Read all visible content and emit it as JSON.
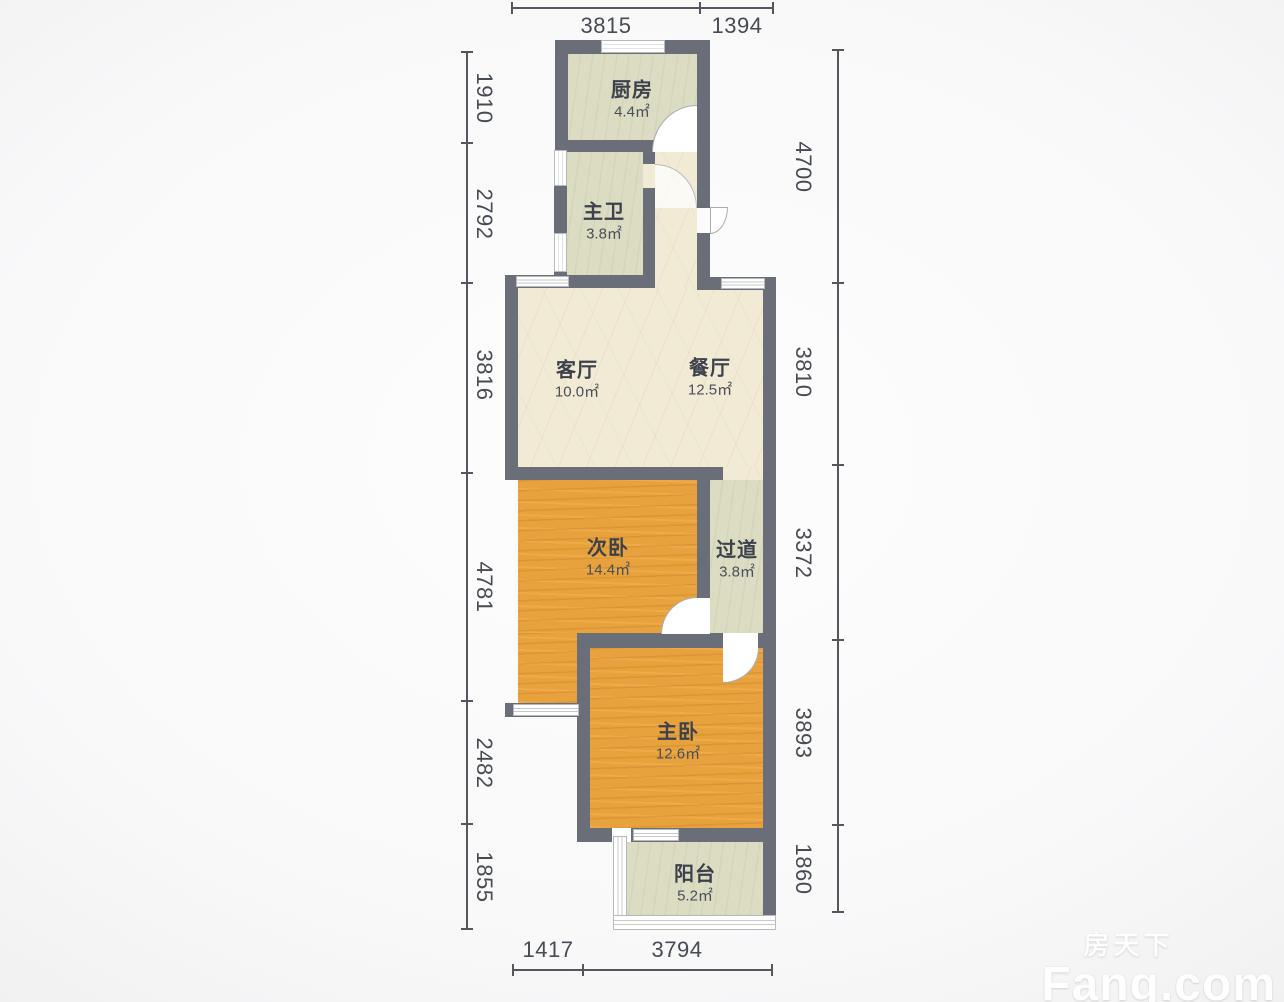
{
  "plan": {
    "rooms": [
      {
        "id": "kitchen",
        "name": "厨房",
        "area": "4.4㎡"
      },
      {
        "id": "master-bath",
        "name": "主卫",
        "area": "3.8㎡"
      },
      {
        "id": "living-room",
        "name": "客厅",
        "area": "10.0㎡"
      },
      {
        "id": "dining-room",
        "name": "餐厅",
        "area": "12.5㎡"
      },
      {
        "id": "second-bedroom",
        "name": "次卧",
        "area": "14.4㎡"
      },
      {
        "id": "hallway",
        "name": "过道",
        "area": "3.8㎡"
      },
      {
        "id": "master-bedroom",
        "name": "主卧",
        "area": "12.6㎡"
      },
      {
        "id": "balcony",
        "name": "阳台",
        "area": "5.2㎡"
      }
    ],
    "dimensions": {
      "top": [
        "3815",
        "1394"
      ],
      "bottom": [
        "1417",
        "3794"
      ],
      "left": [
        "1910",
        "2792",
        "3816",
        "4781",
        "2482",
        "1855"
      ],
      "right": [
        "4700",
        "3810",
        "3372",
        "3893",
        "1860"
      ]
    },
    "colors": {
      "wall": "#6a6e79",
      "living_floor": "#f1ebd5",
      "wet_area_floor": "#dcdcc3",
      "bedroom_floor": "#e7a23d"
    },
    "watermark": {
      "cn": "房天下",
      "en": "Fang.com"
    }
  }
}
